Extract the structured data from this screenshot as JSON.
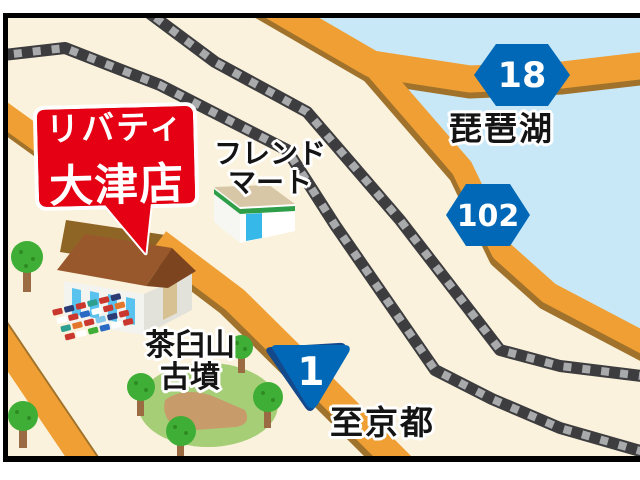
{
  "callout": {
    "line1": "リバティ",
    "line2": "大津店",
    "bg_color": "#e50013",
    "text_color": "#ffffff"
  },
  "labels": {
    "friend_mart_line1": "フレンド",
    "friend_mart_line2": "マート",
    "lake": "琵琶湖",
    "kofun_line1": "茶臼山",
    "kofun_line2": "古墳",
    "to_kyoto": "至京都"
  },
  "route_shields": {
    "prefectural_18": "18",
    "prefectural_102": "102",
    "national_1": "1",
    "shield_color": "#0068b7"
  },
  "colors": {
    "land": "#faf2dc",
    "water": "#c8e8f8",
    "road": "#ef9f34",
    "road_shadow": "#a0722b",
    "railway": "#3d3d3f",
    "railway_tie": "#a9aaac",
    "park_green": "#a6ce77",
    "tree_green": "#3fae37",
    "frame_border": "#000000"
  }
}
